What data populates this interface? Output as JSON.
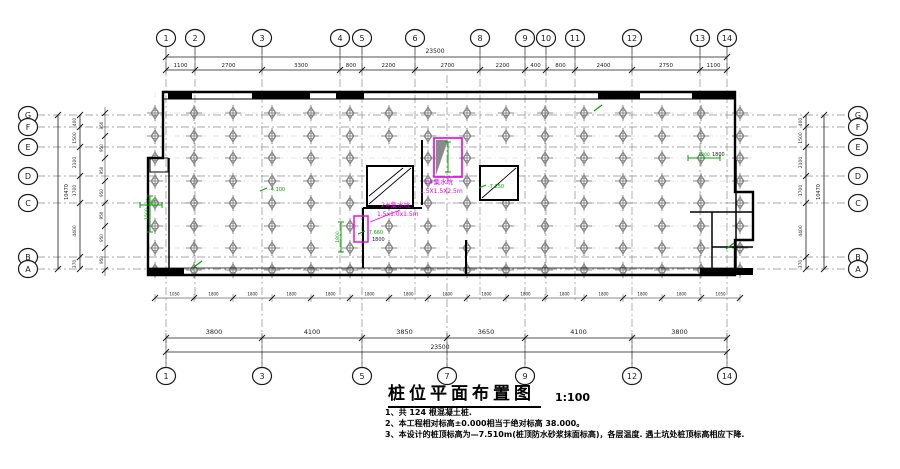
{
  "drawing": {
    "title": "桩位平面布置图",
    "scale": "1:100",
    "notes": [
      "1、共 124 根混凝土桩.",
      "2、本工程相对标高±0.000相当于绝对标高 38.000。",
      "3、本设计的桩顶标高为—7.510m(桩顶防水砂浆抹面标高)，各层温度. 遇土坑处桩顶标高相应下降."
    ]
  },
  "axes": {
    "top": {
      "labels": [
        "1",
        "2",
        "3",
        "4",
        "5",
        "6",
        "8",
        "9",
        "10",
        "11",
        "12",
        "13",
        "14"
      ],
      "x": [
        166,
        195,
        262,
        340,
        362,
        415,
        480,
        525,
        546,
        575,
        632,
        700,
        727
      ],
      "segments": [
        "1100",
        "2700",
        "3300",
        "800",
        "2200",
        "2700",
        "2200",
        "400",
        "800",
        "2400",
        "2750",
        "1100"
      ],
      "overall": "23500"
    },
    "bottom": {
      "labels": [
        "1",
        "3",
        "5",
        "7",
        "9",
        "12",
        "14"
      ],
      "x": [
        166,
        262,
        362,
        447,
        525,
        632,
        727
      ],
      "segments": [
        "3800",
        "4100",
        "3850",
        "3650",
        "4100",
        "3800"
      ],
      "overall": "23500"
    },
    "left": {
      "labels": [
        "G",
        "F",
        "E",
        "D",
        "C",
        "B",
        "A"
      ],
      "y": [
        115,
        127,
        147,
        176,
        203,
        257,
        269
      ],
      "segments": [
        "400",
        "1500",
        "2100",
        "1700",
        "4400",
        "370"
      ],
      "overall": "10470"
    },
    "right": {
      "labels": [
        "G",
        "F",
        "E",
        "D",
        "C",
        "B",
        "A"
      ],
      "y": [
        115,
        127,
        147,
        176,
        203,
        257,
        269
      ],
      "segments": [
        "400",
        "1500",
        "2100",
        "1700",
        "4400",
        "370"
      ],
      "overall": "10470"
    }
  },
  "pile_grid": {
    "cols_x": [
      155,
      194,
      233,
      272,
      311,
      350,
      389,
      428,
      467,
      506,
      545,
      584,
      623,
      662,
      701,
      740
    ],
    "rows_y": [
      113,
      136,
      158,
      181,
      203,
      226,
      248,
      270
    ],
    "skip": [
      [
        2,
        6
      ],
      [
        3,
        6
      ],
      [
        2,
        9
      ],
      [
        3,
        9
      ]
    ],
    "pile_count": "124"
  },
  "sub_dims": {
    "bottom_labels": [
      "1050",
      "1800",
      "1800",
      "1800",
      "1800",
      "1800",
      "1800",
      "1800",
      "1800",
      "1800",
      "1800",
      "1800",
      "1800",
      "1800",
      "1050"
    ],
    "left_labels": [
      "950",
      "950",
      "950",
      "950",
      "950",
      "950",
      "950"
    ]
  },
  "pits": [
    {
      "label": "1#集水坑",
      "size": "1.5X1.5X2.5m",
      "label_x": 424,
      "label_y": 184
    },
    {
      "label": "2#集水坑",
      "size": "1.5x1.0x1.5m",
      "label_x": 381,
      "label_y": 207
    }
  ],
  "green_marks": [
    {
      "type": "vdim",
      "x": 150,
      "y1": 196,
      "y2": 232,
      "label": "1500"
    },
    {
      "type": "vdim",
      "x": 341,
      "y1": 222,
      "y2": 252,
      "label": "1800"
    },
    {
      "type": "vdim",
      "x": 448,
      "y1": 142,
      "y2": 172,
      "label": ""
    },
    {
      "type": "hdim",
      "x1": 140,
      "x2": 162,
      "y": 205,
      "label": "1800"
    },
    {
      "type": "hdim",
      "x1": 688,
      "x2": 720,
      "y": 158,
      "label": "1800"
    },
    {
      "type": "leader",
      "x": 366,
      "y": 234,
      "label": "-7.660"
    },
    {
      "type": "leader",
      "x": 487,
      "y": 188,
      "label": "-7.250"
    },
    {
      "type": "leader",
      "x": 268,
      "y": 191,
      "label": "-4.100"
    },
    {
      "type": "tick",
      "x": 598,
      "y": 108
    },
    {
      "type": "tick",
      "x": 198,
      "y": 264
    },
    {
      "type": "tick",
      "x": 730,
      "y": 246
    }
  ],
  "plan_texts": [
    {
      "text": "1800",
      "x": 372,
      "y": 241
    },
    {
      "text": "1800",
      "x": 712,
      "y": 156
    }
  ],
  "colors": {
    "magenta": "#e800e8",
    "green": "#00a500",
    "line": "#1a1a1a",
    "gray": "#828282",
    "axis": "#8d8d8d"
  }
}
